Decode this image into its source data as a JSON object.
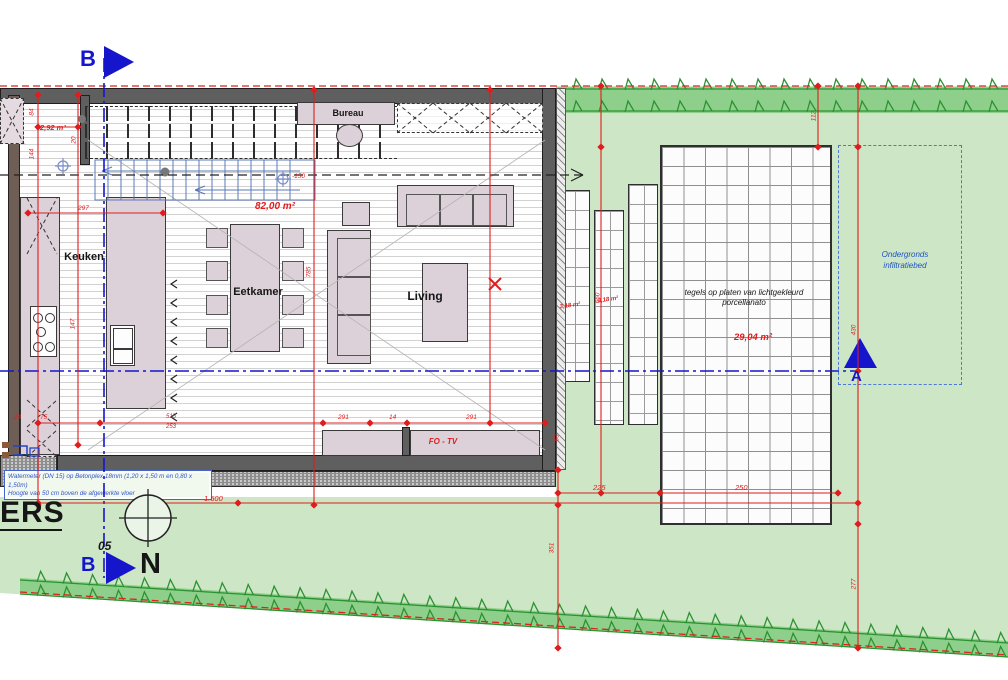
{
  "rooms": {
    "keuken": "Keuken",
    "eetkamer": "Eetkamer",
    "living": "Living",
    "bureau": "Bureau"
  },
  "areas": {
    "storage": "2,92 m²",
    "main": "82,00 m²",
    "strip1": "3,18 m²",
    "strip2": "3,18 m²",
    "strip3": "3,18 m²",
    "terrace": "29,04 m²"
  },
  "annotations": {
    "fo_tv": "FO - TV",
    "terrace_material": "tegels op platen van lichtgekleurd porcellanato",
    "infiltration_line1": "Ondergronds",
    "infiltration_line2": "infiltratiebed",
    "level_marker": "-150",
    "note_line1": "Watermeter (DN 15) op Betonplex 18mm (1,20 x 1,50 m en 0,80 x 1,50m)",
    "note_line2": "Hoogte van 50 cm boven de afgewerkte vloer"
  },
  "section_markers": {
    "b_top": "B",
    "b_bottom": "B",
    "a": "A"
  },
  "north_label": "N",
  "title_block": {
    "ers": "ERS",
    "sheet_number": "05"
  },
  "dimensions": {
    "list": [
      "297",
      "84",
      "144",
      "20",
      "147",
      "785",
      "515",
      "253",
      "291",
      "14",
      "291",
      "63",
      "14",
      "75",
      "1.500",
      "225",
      "250",
      "660",
      "112",
      "430",
      "277",
      "351"
    ]
  },
  "colors": {
    "site_green": "#cde6c6",
    "hedge_green": "#8ed08b",
    "hedge_stroke": "#2c9230",
    "dimension_red": "#e01d1d",
    "section_blue": "#1515cc",
    "furniture_pink": "#dcd1d8",
    "wall_gray": "#5f5f5f"
  }
}
